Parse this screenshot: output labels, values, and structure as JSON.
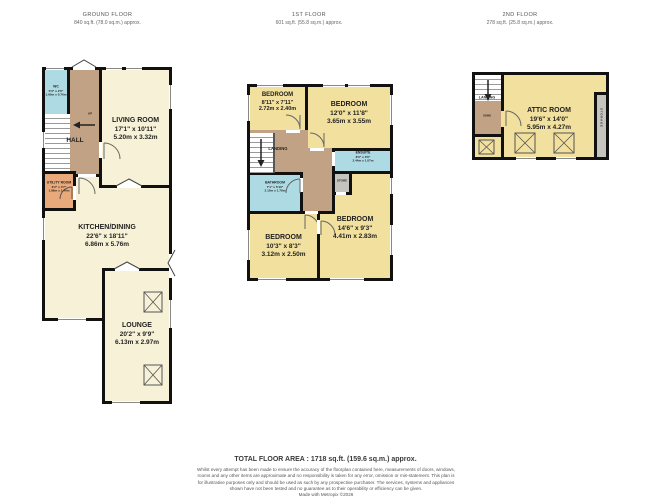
{
  "floors": {
    "ground": {
      "title": "GROUND FLOOR",
      "area": "840 sq.ft. (78.0 sq.m.) approx.",
      "rooms": {
        "wc": {
          "name": "WC",
          "dim_ft": "5'3\" x 2'6\"",
          "dim_m": "1.60m x 0.76m"
        },
        "hall": {
          "name": "HALL"
        },
        "up": "UP",
        "living": {
          "name": "LIVING ROOM",
          "dim_ft": "17'1\"  x 10'11\"",
          "dim_m": "5.20m  x 3.32m"
        },
        "utility": {
          "name": "UTILITY ROOM",
          "dim_ft": "6'2\" x 4'7\"",
          "dim_m": "1.88m x 1.40m"
        },
        "kitchen": {
          "name": "KITCHEN/DINING",
          "dim_ft": "22'6\"  x 18'11\"",
          "dim_m": "6.86m  x 5.76m"
        },
        "lounge": {
          "name": "LOUNGE",
          "dim_ft": "20'2\"  x 9'9\"",
          "dim_m": "6.13m  x 2.97m"
        }
      }
    },
    "first": {
      "title": "1ST FLOOR",
      "area": "601 sq.ft. (55.8 sq.m.) approx.",
      "rooms": {
        "bedroom1": {
          "name": "BEDROOM",
          "dim_ft": "8'11\"  x 7'11\"",
          "dim_m": "2.72m x 2.40m"
        },
        "bedroom2": {
          "name": "BEDROOM",
          "dim_ft": "12'0\"  x 11'8\"",
          "dim_m": "3.65m  x 3.55m"
        },
        "landing": {
          "name": "LANDING"
        },
        "ensuite": {
          "name": "ENSUITE",
          "dim_ft": "8'0\"  x 3'6\"",
          "dim_m": "2.44m  x 1.07m"
        },
        "store": {
          "name": "STORE"
        },
        "bathroom": {
          "name": "BATHROOM",
          "dim_ft": "7'1\"  x 5'10\"",
          "dim_m": "2.15m  x 1.78m"
        },
        "bedroom3": {
          "name": "BEDROOM",
          "dim_ft": "10'3\"  x 8'3\"",
          "dim_m": "3.12m  x 2.50m"
        },
        "bedroom4": {
          "name": "BEDROOM",
          "dim_ft": "14'6\"  x 9'3\"",
          "dim_m": "4.41m  x 2.83m"
        }
      }
    },
    "second": {
      "title": "2ND FLOOR",
      "area": "278 sq.ft. (25.8 sq.m.) approx.",
      "rooms": {
        "landing": {
          "name": "LANDING"
        },
        "down": "DOWN",
        "attic": {
          "name": "ATTIC ROOM",
          "dim_ft": "19'6\"  x 14'0\"",
          "dim_m": "5.95m  x 4.27m"
        },
        "storage": {
          "name": "STORAGE"
        }
      }
    }
  },
  "footer": {
    "total": "TOTAL FLOOR AREA : 1718 sq.ft. (159.6 sq.m.) approx.",
    "disclaimer": "Whilst every attempt has been made to ensure the accuracy of the floorplan contained here, measurements of doors, windows, rooms and any other items are approximate and no responsibility is taken for any error, omission or mis-statement. This plan is for illustrative purposes only and should be used as such by any prospective purchaser. The services, systems and appliances shown have not been tested and no guarantee as to their operability or efficiency can be given.",
    "credit": "Made with Metropix ©2026"
  },
  "colors": {
    "wall": "#111111",
    "room_cream": "#f7f2d7",
    "room_yellow": "#f2e09e",
    "hall_tan": "#c2a284",
    "wet_blue": "#aedbe3",
    "utility_orange": "#e9a97a",
    "store_gray": "#c6c4bf"
  }
}
